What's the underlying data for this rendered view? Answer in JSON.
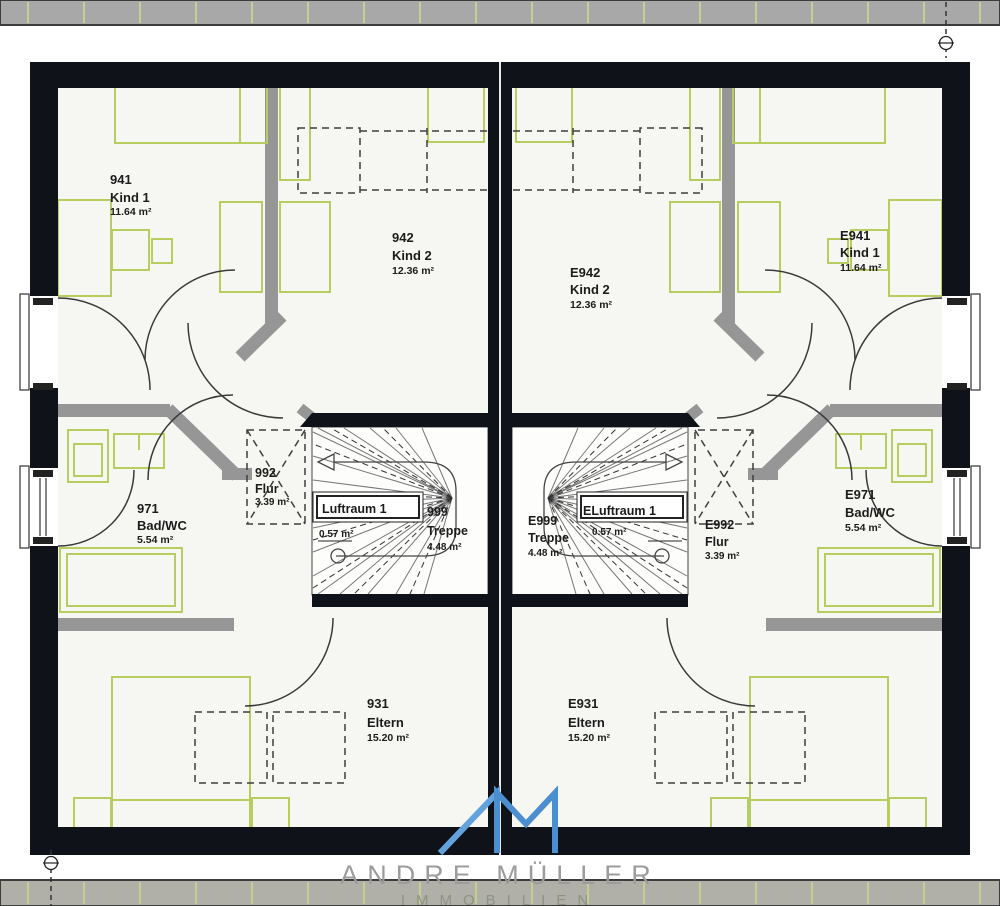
{
  "title": "Obergeschoss Grundriss Doppelhaus",
  "rooms": {
    "left": {
      "kind1": {
        "num": "941",
        "name": "Kind 1",
        "area": "11.64 m²"
      },
      "kind2": {
        "num": "942",
        "name": "Kind 2",
        "area": "12.36 m²"
      },
      "bad": {
        "num": "971",
        "name": "Bad/WC",
        "area": "5.54 m²"
      },
      "flur": {
        "num": "992",
        "name": "Flur",
        "area": "3.39 m²"
      },
      "treppe": {
        "num": "999",
        "name": "Treppe",
        "area": "4.48 m²"
      },
      "luftraum": {
        "name": "Luftraum 1",
        "area": "0.57 m²"
      },
      "eltern": {
        "num": "931",
        "name": "Eltern",
        "area": "15.20 m²"
      }
    },
    "right": {
      "kind1": {
        "num": "E941",
        "name": "Kind 1",
        "area": "11.64 m²"
      },
      "kind2": {
        "num": "E942",
        "name": "Kind 2",
        "area": "12.36 m²"
      },
      "bad": {
        "num": "E971",
        "name": "Bad/WC",
        "area": "5.54 m²"
      },
      "flur": {
        "num": "E992",
        "name": "Flur",
        "area": "3.39 m²"
      },
      "treppe": {
        "num": "E999",
        "name": "Treppe",
        "area": "4.48 m²"
      },
      "luftraum": {
        "name": "ELuftraum 1",
        "area": "0.57 m²"
      },
      "eltern": {
        "num": "E931",
        "name": "Eltern",
        "area": "15.20 m²"
      }
    }
  },
  "logo": {
    "monogram": "AM",
    "company": "ANDRE MÜLLER",
    "division": "IMMOBILIEN"
  },
  "colors": {
    "exterior_wall": "#10121a",
    "interior_wall": "#969696",
    "furniture_green": "#b7cd5f",
    "floor": "#f6f6f3",
    "band_gray": "#a8a8a8",
    "logo_blue_light": "#63a3dd",
    "logo_blue_dark": "#4b8fd0"
  }
}
